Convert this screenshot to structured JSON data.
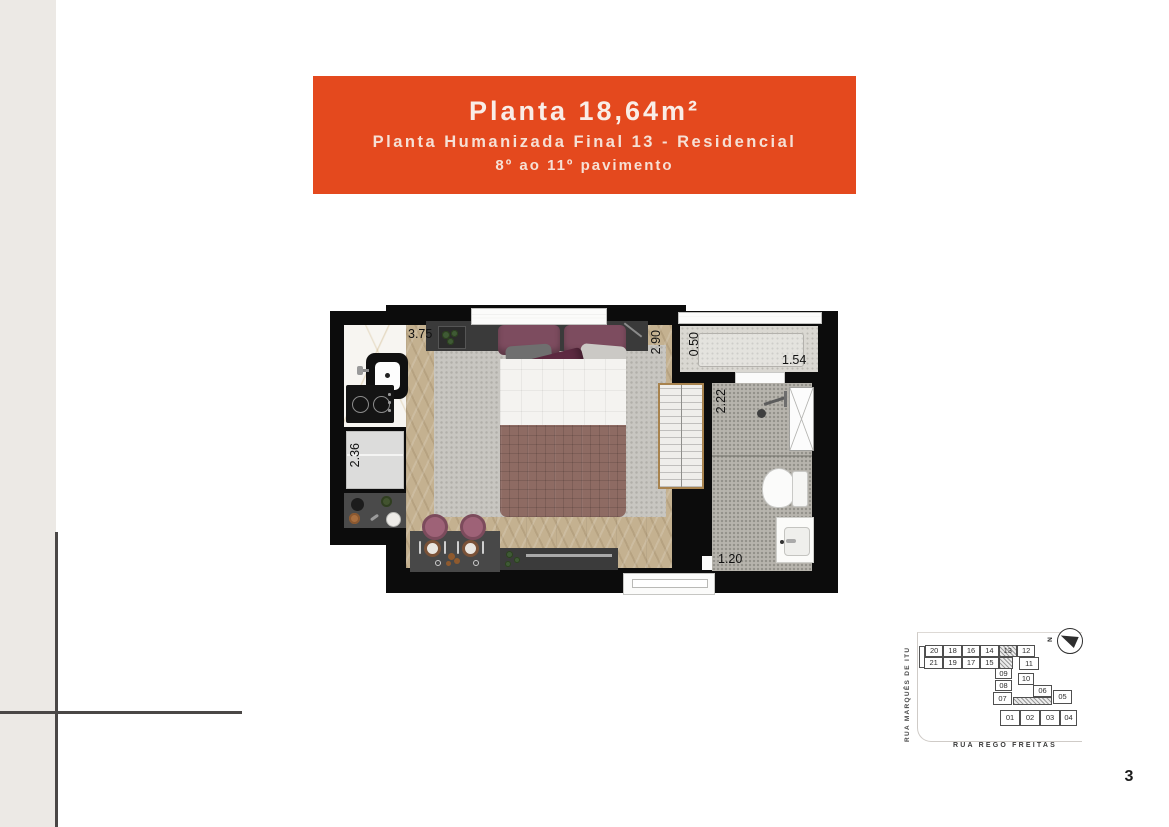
{
  "page": {
    "number": "3"
  },
  "header": {
    "title": "Planta 18,64m²",
    "subtitle": "Planta Humanizada Final 13 - Residencial",
    "floors": "8º ao 11º pavimento",
    "bg_color": "#E4491E",
    "text_color": "#F6E0D5"
  },
  "floor_plan": {
    "dimension_labels": [
      {
        "text": "3.75",
        "x": 78,
        "y": 22,
        "vertical": false
      },
      {
        "text": "2.36",
        "x": 18,
        "y": 138,
        "vertical": true
      },
      {
        "text": "2.90",
        "x": 319,
        "y": 25,
        "vertical": true
      },
      {
        "text": "0.50",
        "x": 357,
        "y": 27,
        "vertical": true
      },
      {
        "text": "1.54",
        "x": 452,
        "y": 48,
        "vertical": false
      },
      {
        "text": "2.22",
        "x": 384,
        "y": 84,
        "vertical": true
      },
      {
        "text": "1.20",
        "x": 388,
        "y": 247,
        "vertical": false
      }
    ],
    "colors": {
      "wall": "#0C0C0C",
      "wood_floor": "#C4B190",
      "rug": "#C8C6C1",
      "bath_floor": "#B7B4AD",
      "dark_furniture": "#474747",
      "stool": "#9E6277",
      "blanket": "#8E6B63",
      "pillow_accent": "#5D2A41"
    }
  },
  "key_plan": {
    "street_left": "RUA MARQUÊS DE ITU",
    "street_bottom": "RUA REGO FREITAS",
    "north_label": "N",
    "highlighted_unit": "13",
    "units": [
      {
        "label": "20",
        "x": 20,
        "y": 33,
        "w": 18.4,
        "h": 12,
        "hatched": false
      },
      {
        "label": "18",
        "x": 38.4,
        "y": 33,
        "w": 18.4,
        "h": 12,
        "hatched": false
      },
      {
        "label": "16",
        "x": 56.8,
        "y": 33,
        "w": 18.4,
        "h": 12,
        "hatched": false
      },
      {
        "label": "14",
        "x": 75.2,
        "y": 33,
        "w": 18.4,
        "h": 12,
        "hatched": false
      },
      {
        "label": "13",
        "x": 93.6,
        "y": 33,
        "w": 18.4,
        "h": 12,
        "hatched": true
      },
      {
        "label": "12",
        "x": 112,
        "y": 33,
        "w": 18.4,
        "h": 12,
        "hatched": false
      },
      {
        "label": "21",
        "x": 19,
        "y": 45,
        "w": 19.4,
        "h": 12,
        "hatched": false
      },
      {
        "label": "19",
        "x": 38.4,
        "y": 45,
        "w": 18.4,
        "h": 12,
        "hatched": false
      },
      {
        "label": "17",
        "x": 56.8,
        "y": 45,
        "w": 18.4,
        "h": 12,
        "hatched": false
      },
      {
        "label": "15",
        "x": 75.2,
        "y": 45,
        "w": 18.4,
        "h": 12,
        "hatched": false
      },
      {
        "label": "",
        "x": 93.6,
        "y": 45,
        "w": 14,
        "h": 12,
        "hatched": true
      },
      {
        "label": "11",
        "x": 114,
        "y": 45,
        "w": 20,
        "h": 13,
        "hatched": false
      },
      {
        "label": "09",
        "x": 90,
        "y": 56,
        "w": 17,
        "h": 11,
        "hatched": false
      },
      {
        "label": "10",
        "x": 113,
        "y": 61,
        "w": 16,
        "h": 12,
        "hatched": false
      },
      {
        "label": "08",
        "x": 90,
        "y": 68,
        "w": 17,
        "h": 11,
        "hatched": false
      },
      {
        "label": "07",
        "x": 88,
        "y": 80,
        "w": 19,
        "h": 13,
        "hatched": false
      },
      {
        "label": "06",
        "x": 128,
        "y": 73,
        "w": 19,
        "h": 12,
        "hatched": false
      },
      {
        "label": "05",
        "x": 148,
        "y": 78,
        "w": 19,
        "h": 14,
        "hatched": false
      },
      {
        "label": "",
        "x": 108,
        "y": 85,
        "w": 39,
        "h": 8,
        "hatched": true
      },
      {
        "label": "01",
        "x": 95,
        "y": 98,
        "w": 20,
        "h": 16,
        "hatched": false
      },
      {
        "label": "02",
        "x": 115,
        "y": 98,
        "w": 20,
        "h": 16,
        "hatched": false
      },
      {
        "label": "03",
        "x": 135,
        "y": 98,
        "w": 20,
        "h": 16,
        "hatched": false
      },
      {
        "label": "04",
        "x": 155,
        "y": 98,
        "w": 17,
        "h": 16,
        "hatched": false
      }
    ]
  }
}
